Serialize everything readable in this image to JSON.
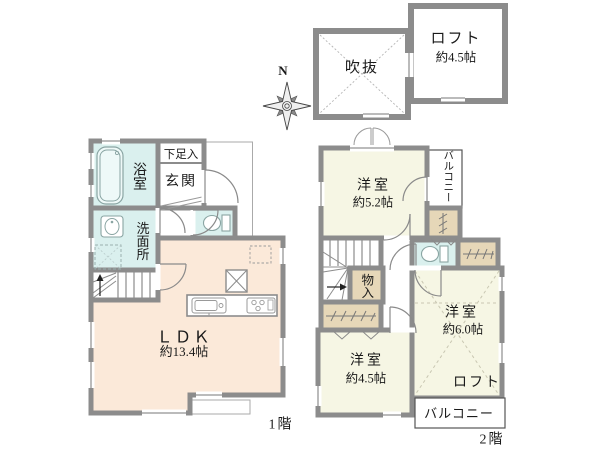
{
  "title": "floor-plan",
  "colors": {
    "wall": "#8c8c8c",
    "western_room_fill": "#f6f6e4",
    "ldk_fill": "#fbe9d9",
    "wet_area_fill": "#daf0ee",
    "closet_fill": "#e6d7b8",
    "text": "#1a1a1a"
  },
  "compass": {
    "north_label": "N"
  },
  "loft_plan": {
    "void_label": "吹抜",
    "loft_label": "ロフト",
    "loft_size": "約4.5帖"
  },
  "floor1": {
    "floor_label": "1階",
    "bath_label": "浴室",
    "shoe_closet_label": "下足入",
    "entrance_label": "玄関",
    "washroom_label": "洗面所",
    "ldk_label": "ＬＤＫ",
    "ldk_size": "約13.4帖"
  },
  "floor2": {
    "floor_label": "2階",
    "room_5_2_label": "洋室",
    "room_5_2_size": "約5.2帖",
    "balcony_top_label": "バルコニー",
    "storage_label": "物入",
    "room_4_5_label": "洋室",
    "room_4_5_size": "約4.5帖",
    "room_6_0_label": "洋室",
    "room_6_0_size": "約6.0帖",
    "loft_label": "ロフト",
    "balcony_bottom_label": "バルコニー"
  }
}
